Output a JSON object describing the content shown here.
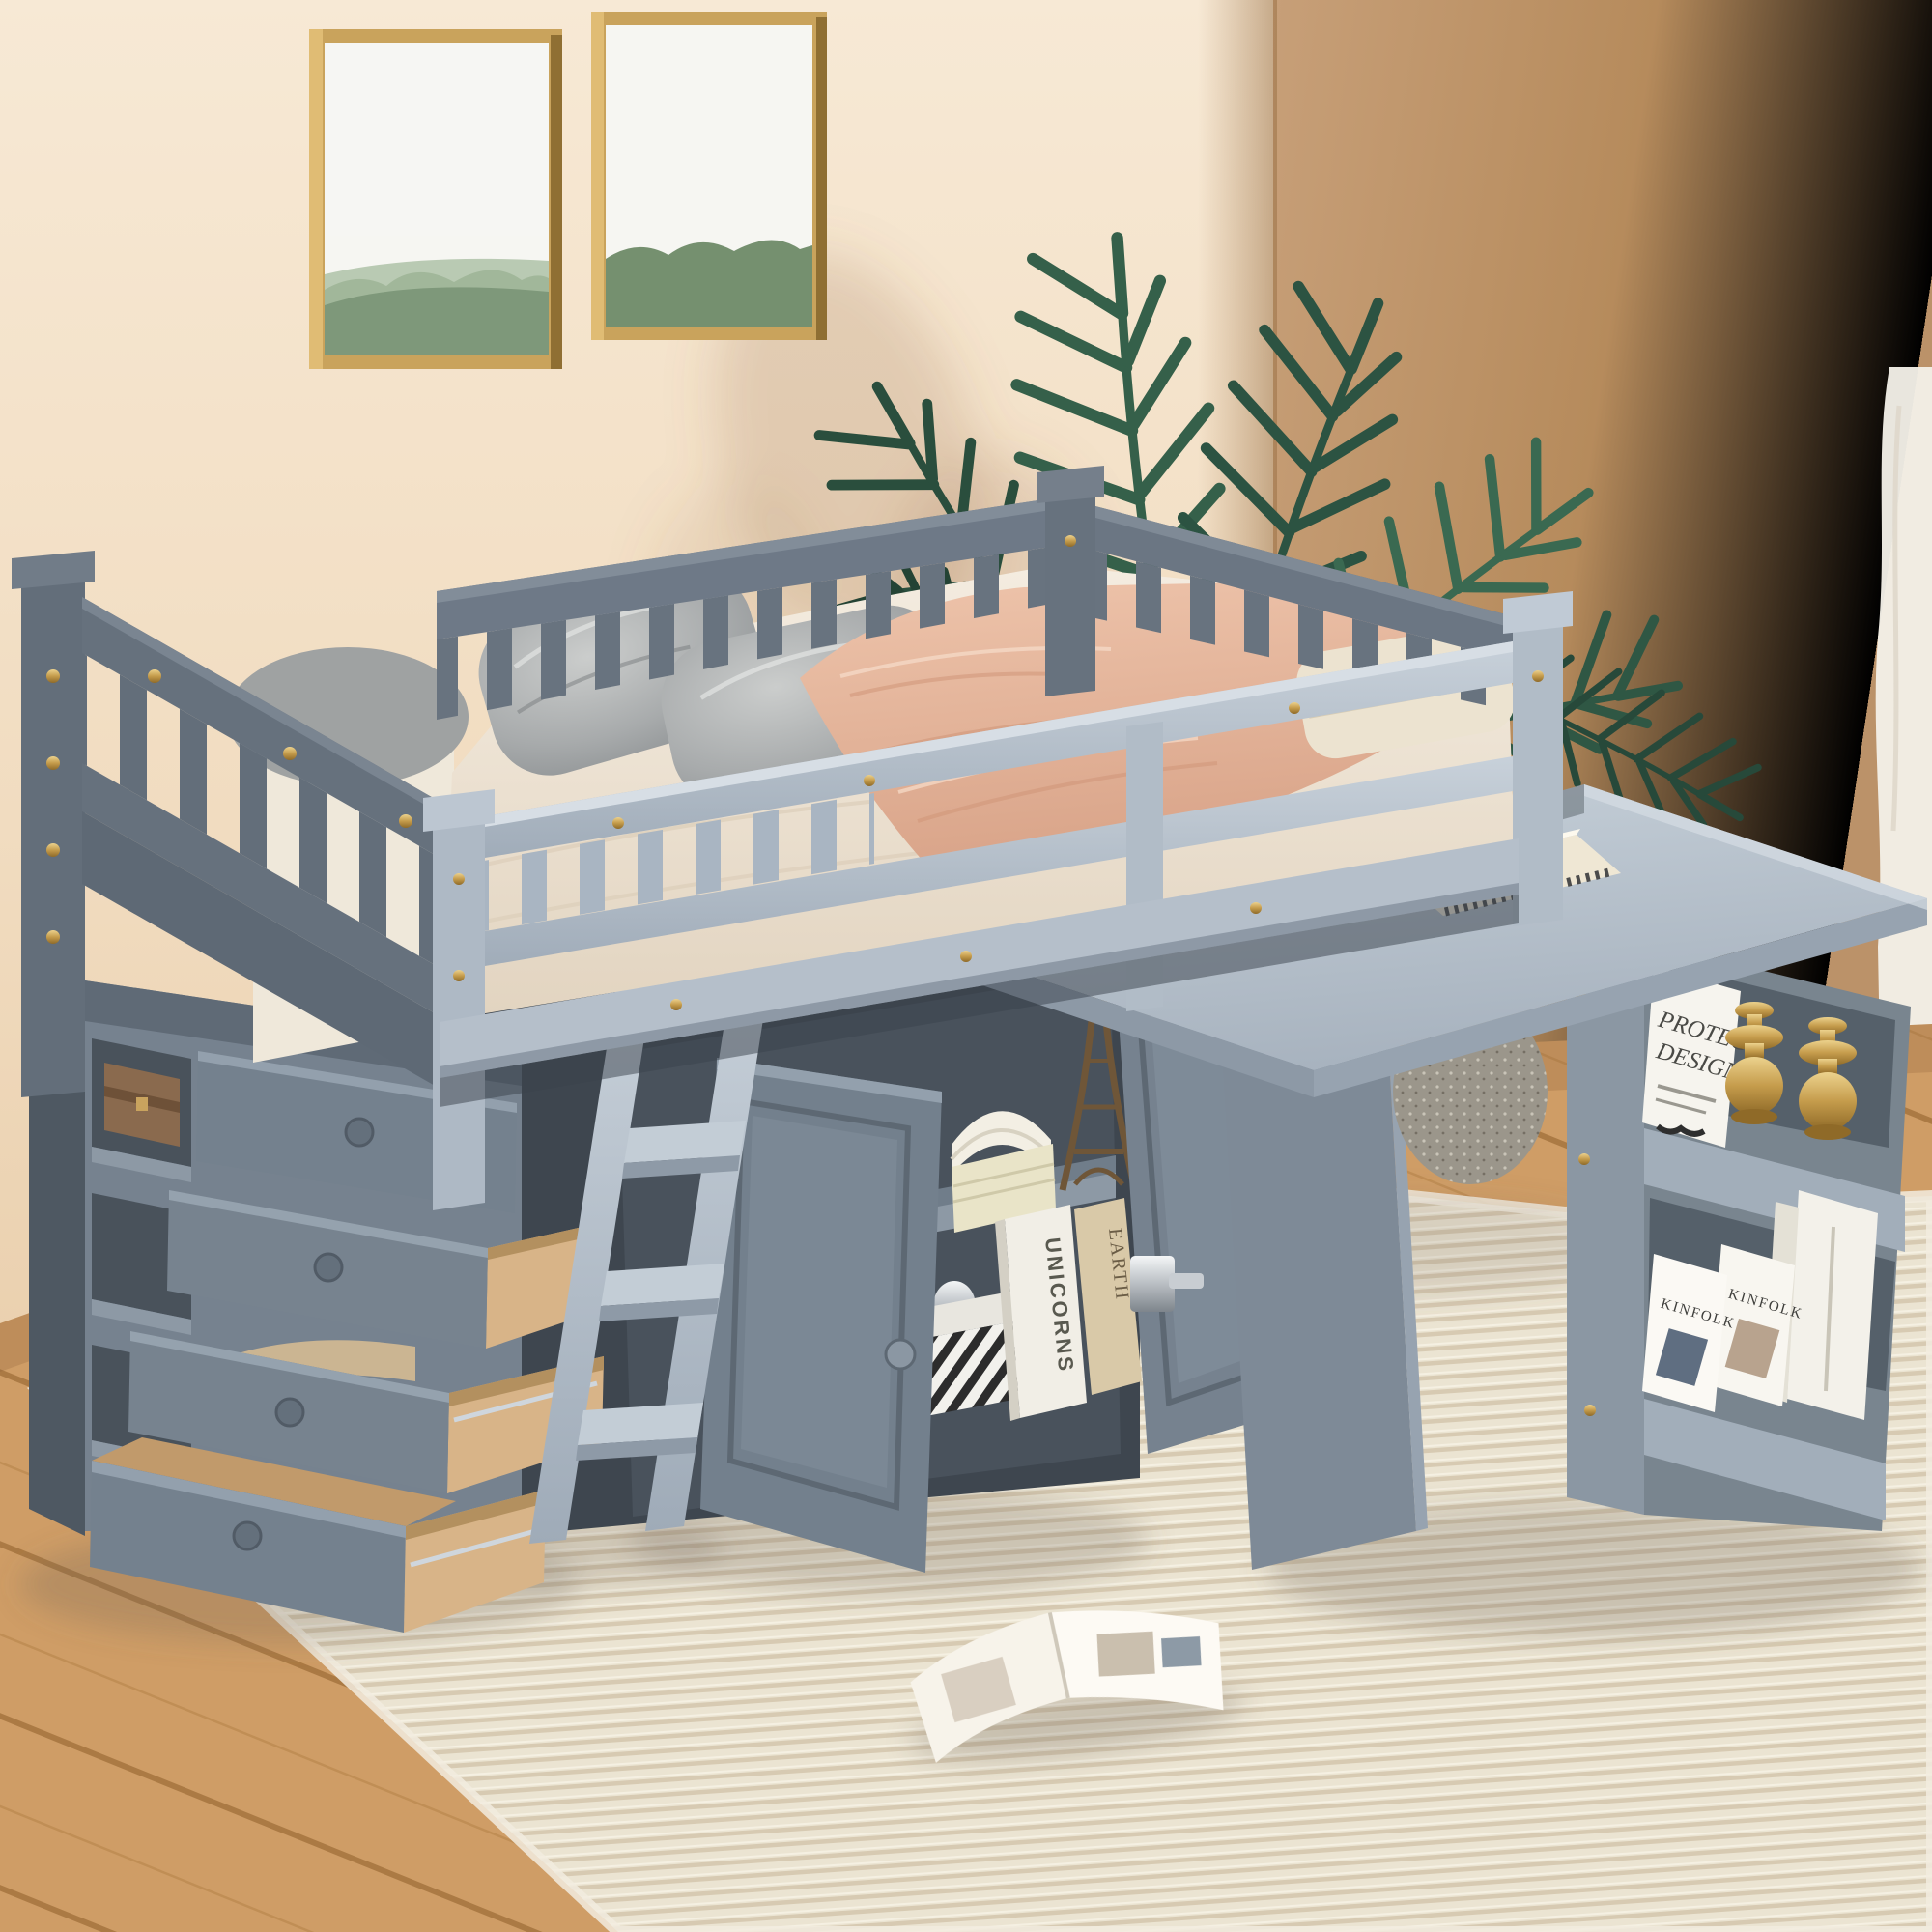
{
  "scene": {
    "description": "Gray twin loft bed with storage chest, ladder, cabinet, pull-out desk and bookshelf in a beige bedroom",
    "palette": {
      "wall_left": "#f3e2cb",
      "wall_right": "#bd9671",
      "wood_floor": "#cf9c63",
      "rug": "#ebe4d2",
      "furniture_gray_light": "#b3bfca",
      "furniture_gray_dark": "#6e7987",
      "bedding_blush": "#e8bca6",
      "bedding_cream": "#efe7da",
      "accent_gold": "#c9a35e",
      "plant_green": "#2f5744"
    }
  },
  "text": {
    "book_spine_unicorns": "UNICORNS",
    "book_spine_earth": "EARTH",
    "magazine_kinfolk_a": "KINFOLK",
    "magazine_kinfolk_b": "KINFOLK",
    "poster_line_1": "PROTECT",
    "poster_line_2": "DESIGN"
  },
  "objects": [
    "wall-art-frame-1",
    "wall-art-frame-2",
    "palm-plant",
    "curtain",
    "loft-bed",
    "headboard",
    "guard-rails",
    "gray-pillows",
    "cream-pillow",
    "blush-blanket",
    "folded-blanket",
    "storage-chest",
    "chest-drawers",
    "cubby-box",
    "bed-ladder",
    "under-bed-cabinet",
    "cabinet-doors",
    "eiffel-tower-figurine",
    "open-book",
    "magazine-stack",
    "striped-box",
    "chrome-trophy",
    "pullout-desk",
    "spiral-notebook",
    "desk-shelf-unit",
    "shelf-poster",
    "gold-vases",
    "kinfolk-magazines",
    "white-books",
    "floor-pouf",
    "open-magazine-on-rug",
    "area-rug",
    "wood-floor"
  ]
}
